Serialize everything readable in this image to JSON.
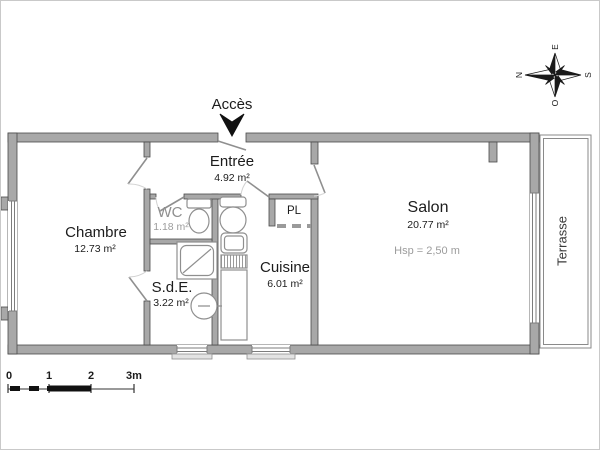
{
  "plan": {
    "access_label": "Accès",
    "rooms": {
      "chambre": {
        "name": "Chambre",
        "area": "12.73 m²"
      },
      "entree": {
        "name": "Entrée",
        "area": "4.92 m²"
      },
      "wc": {
        "name": "WC",
        "area": "1.18 m²"
      },
      "sde": {
        "name": "S.d.E.",
        "area": "3.22 m²"
      },
      "cuisine": {
        "name": "Cuisine",
        "area": "6.01 m²"
      },
      "salon": {
        "name": "Salon",
        "area": "20.77 m²",
        "ceiling_height": "Hsp = 2,50 m"
      },
      "placard": {
        "name": "PL"
      },
      "terrasse": {
        "name": "Terrasse"
      }
    }
  },
  "compass": {
    "north": "N",
    "east": "E",
    "south": "S",
    "west": "O"
  },
  "scale_bar": {
    "ticks": [
      "0",
      "1",
      "2",
      "3m"
    ]
  },
  "colors": {
    "wall_fill": "#a8a8a8",
    "wall_outline": "#4a4a4a",
    "fixture_line": "#8f8f8f",
    "text": "#1c1c1c",
    "muted_text": "#8f8f8f"
  }
}
